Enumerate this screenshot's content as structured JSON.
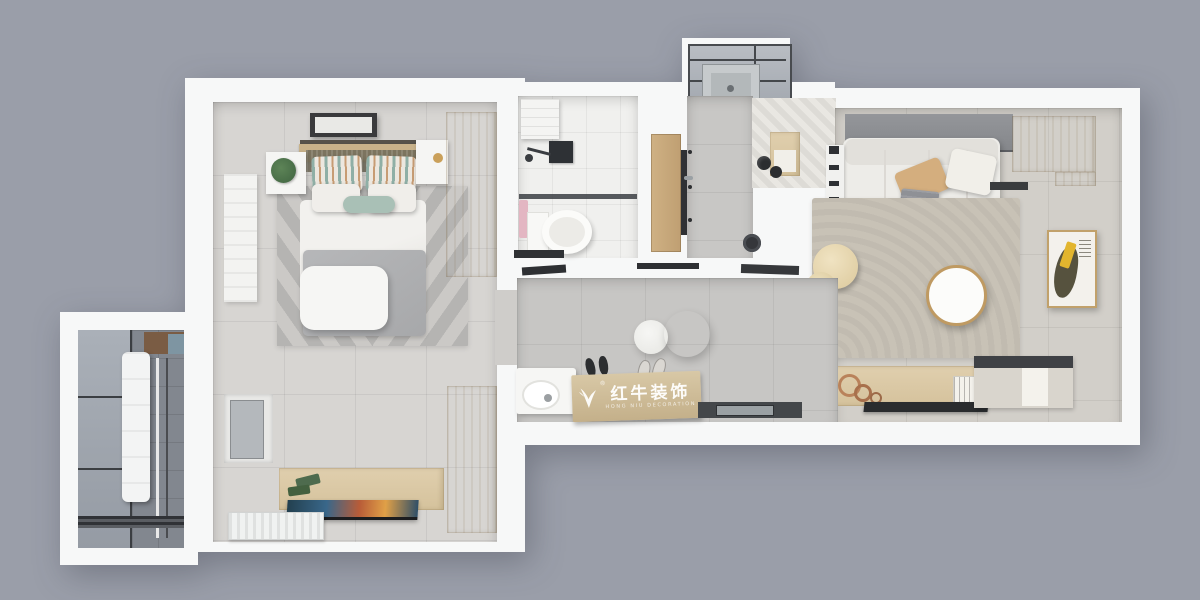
{
  "watermark": {
    "text_cn": "红牛装饰",
    "text_en": "HONG NIU DECORATION",
    "registered": "®",
    "logo_icon": "bull-logo-icon"
  },
  "scene": {
    "type": "3d-floor-plan-top-down-render",
    "background_color": "#9a9ea9",
    "wall_color": "#f7f8f8",
    "accent_wood_color": "#d8c6a2",
    "teal_accent_color": "#9fbcb4",
    "tan_accent_color": "#d2ad7c",
    "art_yellow_color": "#e2b52e",
    "rooms": [
      {
        "id": "bedroom",
        "label": "master-bedroom",
        "floor_color": "#d7d5d2",
        "items": [
          "ceiling-light",
          "double-bed",
          "striped-pillows",
          "teal-bolster",
          "chevron-rug",
          "nightstand-with-plant",
          "nightstand",
          "white-ottoman",
          "wardrobe-upper",
          "wardrobe-lower",
          "full-length-mirror",
          "window-bay",
          "tv-console",
          "wall-tv",
          "radiator"
        ]
      },
      {
        "id": "bathroom",
        "label": "bathroom",
        "floor_color": "#efefed",
        "items": [
          "storage-shelf",
          "shower-set",
          "glass-partition",
          "toilet",
          "pink-towel"
        ]
      },
      {
        "id": "entry",
        "label": "entry-hall",
        "floor_color": "#c8c7c5",
        "items": [
          "entry-door",
          "glazed-utility-box",
          "utility-sink",
          "herringbone-mat",
          "shoe-cabinet",
          "stool",
          "stool",
          "robot-vacuum",
          "spotlights"
        ]
      },
      {
        "id": "living",
        "label": "living-room",
        "floor_color": "#d2cfc9",
        "items": [
          "gray-wall-panel",
          "sofa",
          "tan-pillow",
          "white-pillow",
          "throw-blanket",
          "bookshelf",
          "corner-wood-cabinet",
          "ac-vent",
          "area-rug",
          "pouf",
          "pouf-small",
          "round-coffee-table",
          "wall-art",
          "media-console",
          "tv-panel",
          "sideboard"
        ]
      },
      {
        "id": "kitchen",
        "label": "kitchen-dining",
        "floor_color": "#c7c6c4",
        "items": [
          "ceiling-track-lights",
          "pendant-lamp",
          "pendant-lamp",
          "washbasin-vanity",
          "mirror-shelf",
          "bar-table-with-watermark",
          "slippers-dark",
          "slippers-light",
          "counter-with-sink"
        ]
      },
      {
        "id": "balcony",
        "label": "laundry-balcony",
        "floor_color": "#8e939b",
        "items": [
          "glass-windows",
          "water-heater",
          "drying-rack",
          "threshold"
        ]
      }
    ]
  }
}
